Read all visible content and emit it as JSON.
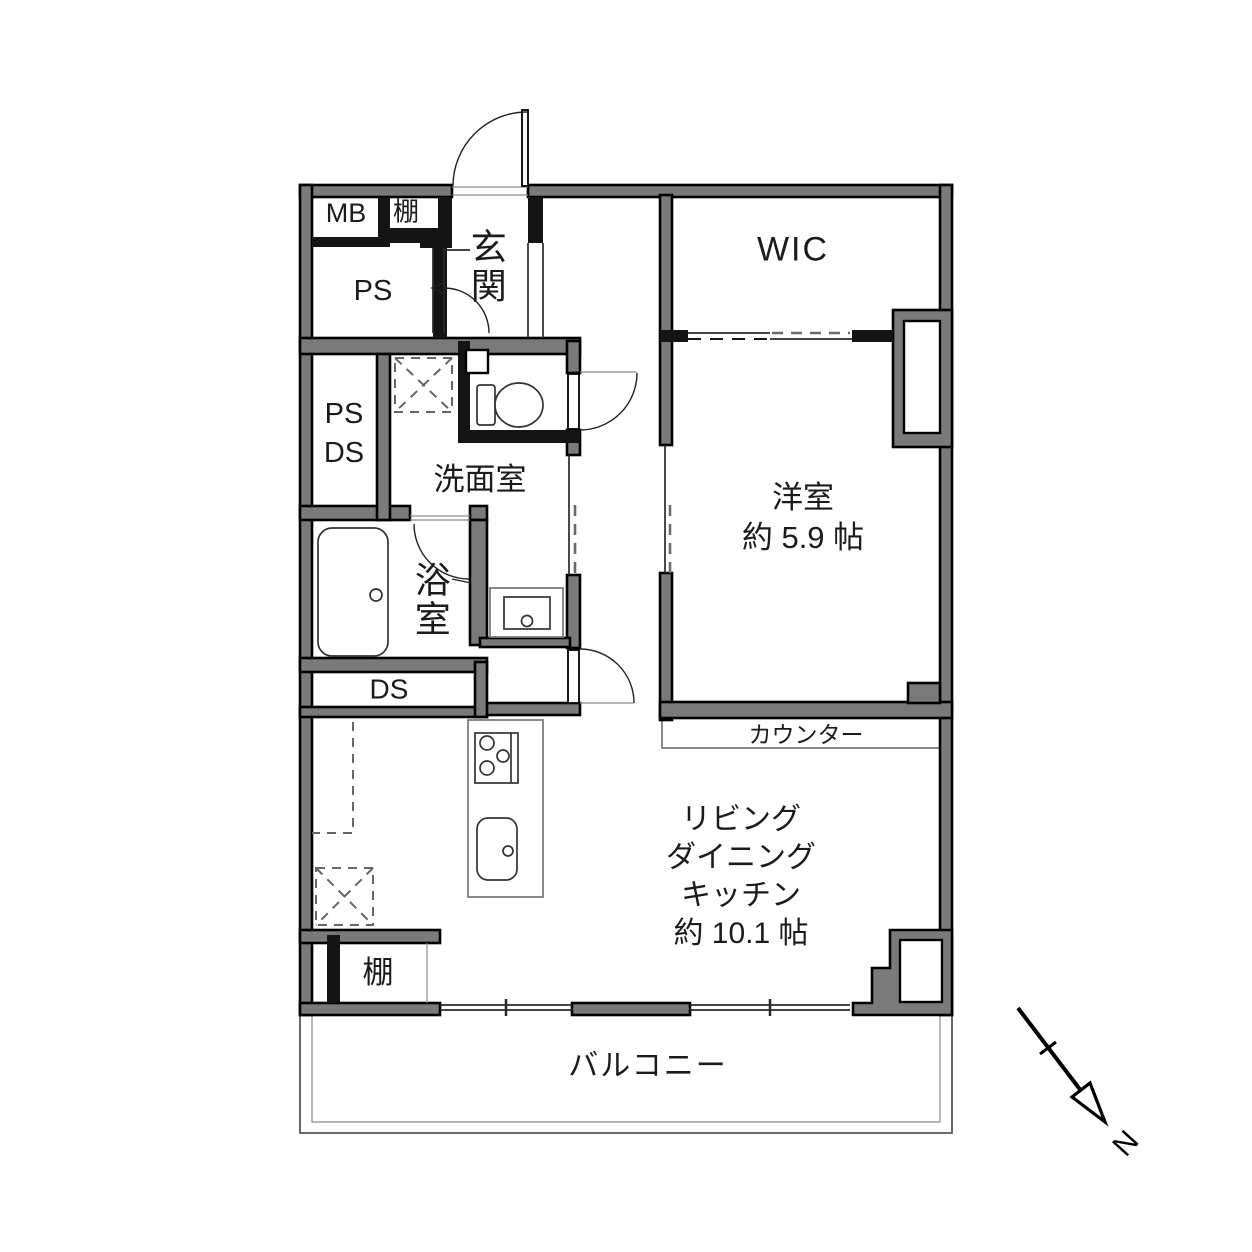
{
  "document": {
    "kind": "apartment-floor-plan",
    "language": "ja"
  },
  "labels": {
    "mb": "MB",
    "shelf_top": "棚",
    "ps_top": "PS",
    "entrance": "玄関",
    "wic": "WIC",
    "ps_mid": "PS",
    "ds_mid": "DS",
    "washroom": "洗面室",
    "bathroom": "浴室",
    "ds_band": "DS",
    "western_room": [
      "洋室",
      "約 5.9 帖"
    ],
    "counter": "カウンター",
    "ldk": [
      "リビング",
      "ダイニング",
      "キッチン",
      "約 10.1 帖"
    ],
    "shelf_bottom": "棚",
    "balcony": "バルコニー",
    "north": "N"
  },
  "room_sizes": {
    "western_room": "約 5.9 帖",
    "living_dining_kitchen": "約 10.1 帖"
  },
  "fixture_icons": [
    "toilet-icon",
    "bathtub-icon",
    "washbasin-icon",
    "stove-icon",
    "kitchen-sink-icon",
    "washing-machine-space-icon",
    "refrigerator-space-icon",
    "north-arrow-icon"
  ],
  "colors": {
    "background": "#ffffff",
    "wall_fill": "#7a7a7a",
    "wall_edge": "#000000",
    "line": "#1a1a1a",
    "thin_line": "#555555",
    "dash": "#777777",
    "text": "#1b1b1b"
  }
}
